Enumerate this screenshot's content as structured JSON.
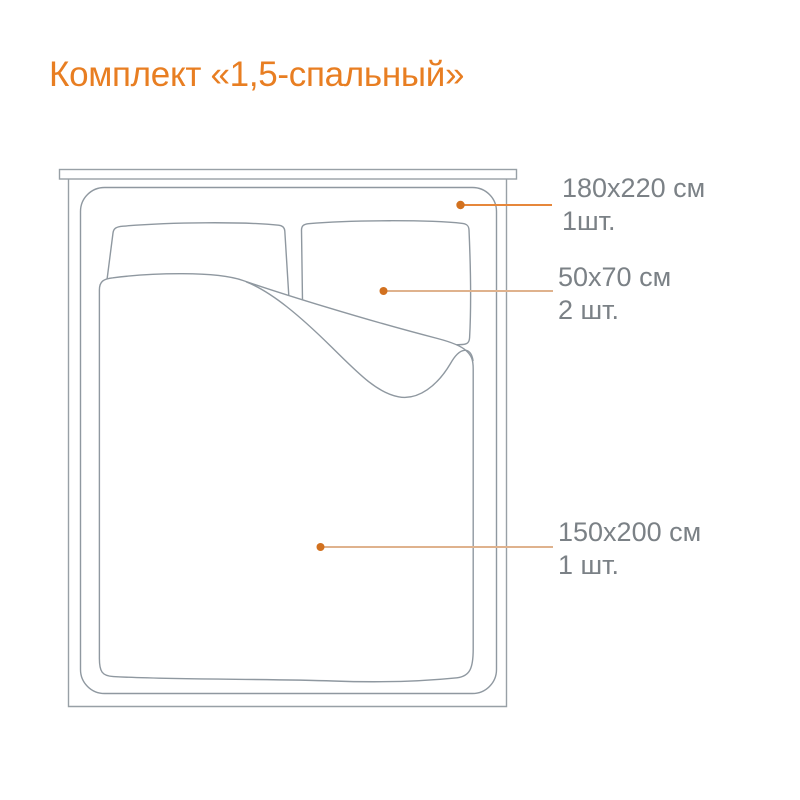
{
  "title": "Комплект «1,5-спальный»",
  "callouts": [
    {
      "id": "sheet",
      "size": "180x220 см",
      "qty": "1шт."
    },
    {
      "id": "pillowcase",
      "size": "50x70 см",
      "qty": "2 шт."
    },
    {
      "id": "duvet-cover",
      "size": "150x200 см",
      "qty": "1 шт."
    }
  ],
  "colors": {
    "accent_orange": "#E87E22",
    "leader_line_strong": "#E6873B",
    "leader_line_soft": "#DFB28D",
    "callout_dot": "#D2711F",
    "label_text": "#7B8186",
    "diagram_line": "#939BA3"
  },
  "icons": {
    "callout_marker": "dot-icon"
  }
}
